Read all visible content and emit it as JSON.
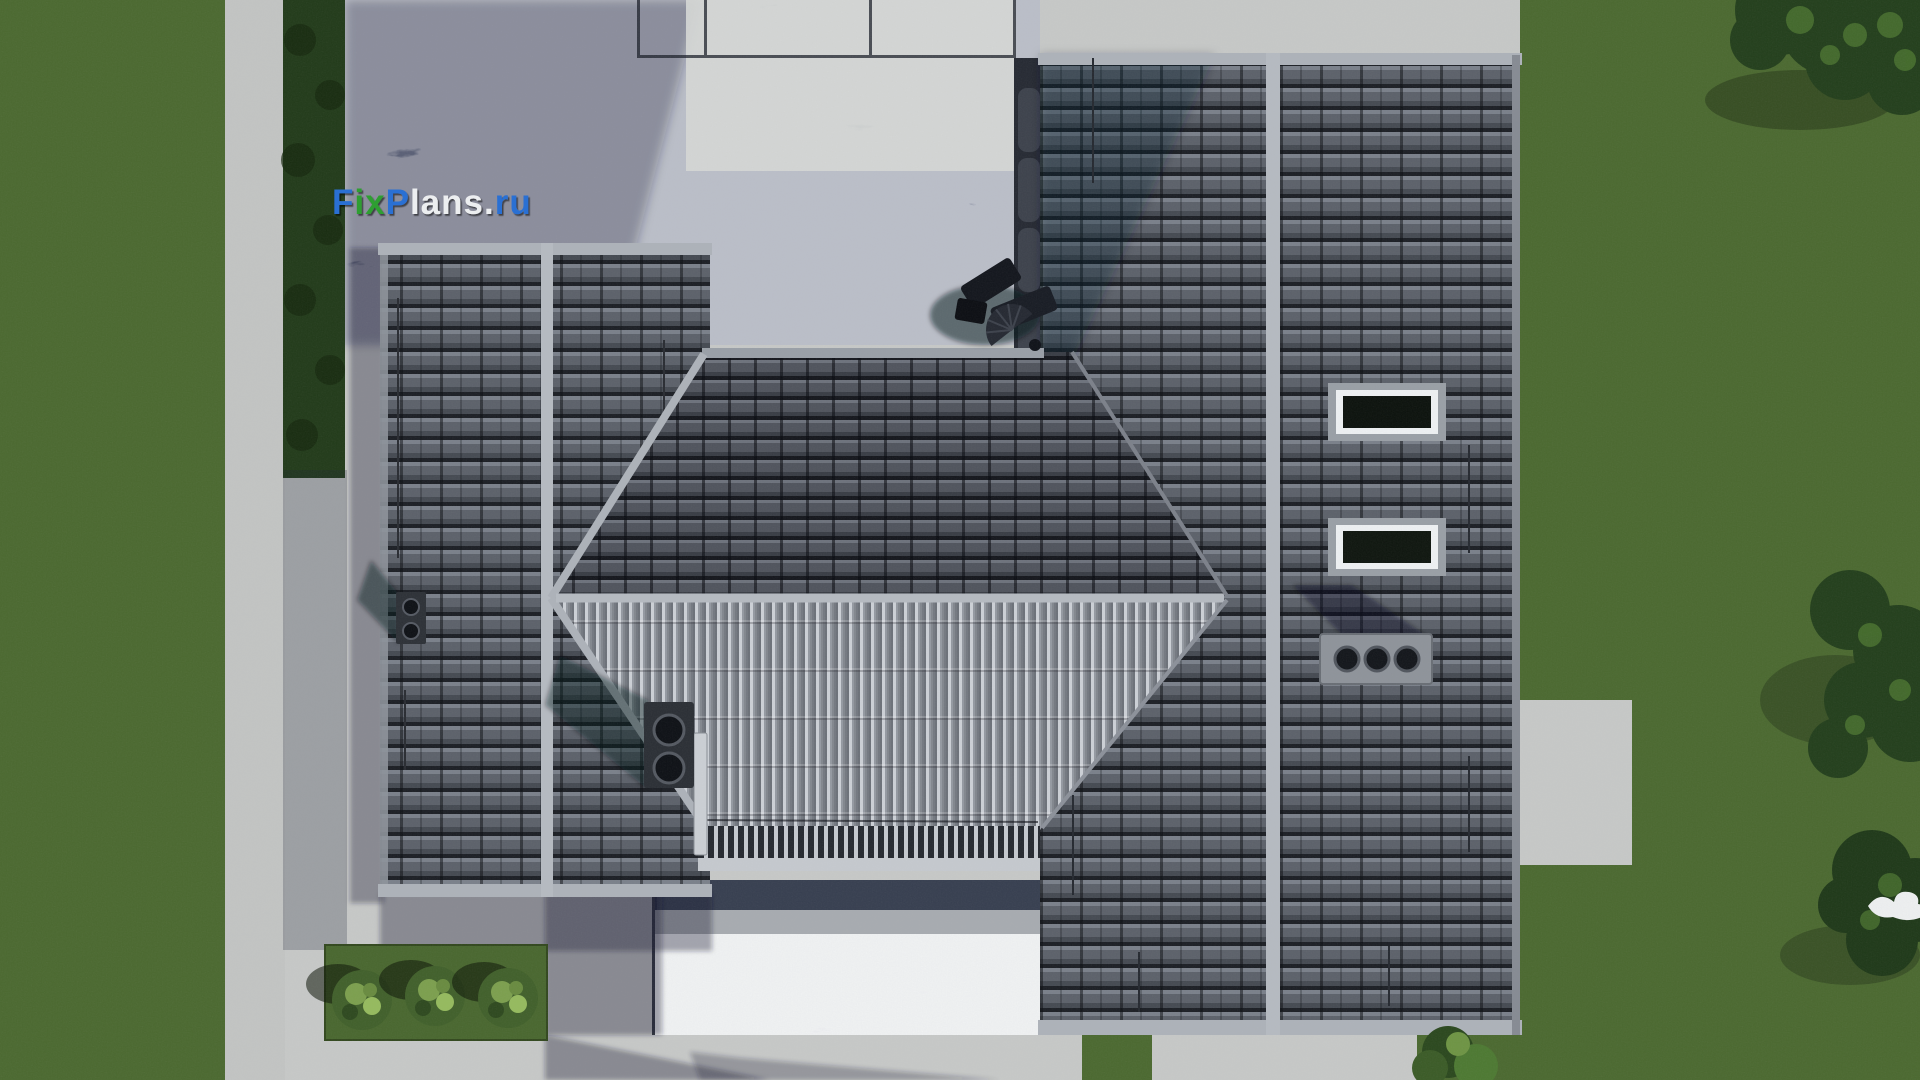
{
  "watermark": {
    "full": "FixPlans.ru",
    "f": "F",
    "ix": "ix",
    "p": "P",
    "lans": "lans",
    "dot": ".",
    "ru": "ru"
  },
  "palette": {
    "watermark_blue": "#2b6fd3",
    "watermark_green": "#2f9e33",
    "watermark_white": "#eceef0",
    "grass": "#4c6a31",
    "grass_bed": "#4a6830",
    "hedge": "#233c1b",
    "tree": "#24401d",
    "tree_speckle": "#4c7531",
    "bush": "#42612c",
    "bush_light": "#7da04f",
    "concrete": "#c7c9c8",
    "concrete_path": "#c3c5c4",
    "concrete_bright": "#d6d8d6",
    "marble_dark": "#767e93",
    "marble_light": "#e9ebee",
    "roof_tile": "#5d626b",
    "roof_tile_center": "#51555e",
    "roof_ribbed": "#a2a7af",
    "ridge_cap": "#b6bbc2",
    "eave_band": "#aeb3ba",
    "skylight_frame_outer": "#9aa0a7",
    "skylight_frame_white": "#eef1f3",
    "skylight_glass": "#0d130e",
    "vent_dark": "#343841",
    "vent_gray": "#8f949b",
    "vent_hole": "#0f1217",
    "wall_dark": "#272b34",
    "bird_white": "#eef0f1",
    "shadow": "rgba(28,34,50,0.36)"
  },
  "scene": {
    "type": "aerial-roof-plan-render",
    "roof_sections": [
      "left-gable-wing",
      "center-hip-roof",
      "right-gable-wing"
    ],
    "skylight_count": 2,
    "objects": [
      "skylight-1",
      "skylight-2",
      "double-vent-chimney-right-roof",
      "triple-vent-chimney-right-roof",
      "double-vent-chimney-center-roof",
      "small-vent-chimney-left-roof",
      "patio-furniture",
      "downspout-pipes",
      "garden-bush-1",
      "garden-bush-2",
      "garden-bush-3",
      "driveway-bush",
      "tree-canopy-top-right",
      "tree-canopy-mid-right",
      "tree-canopy-bottom-right",
      "white-bird"
    ]
  }
}
